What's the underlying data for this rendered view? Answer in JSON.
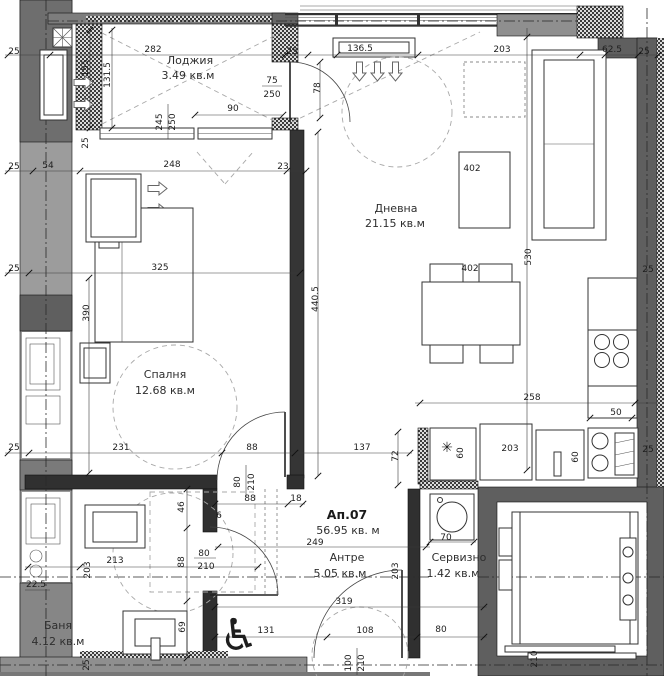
{
  "plan": {
    "apartment": {
      "number": "Ап.07",
      "area": "56.95 кв. м"
    },
    "rooms": {
      "loggia": {
        "name": "Лоджия",
        "area": "3.49 кв.м"
      },
      "living": {
        "name": "Дневна",
        "area": "21.15 кв.м"
      },
      "bedroom": {
        "name": "Спалня",
        "area": "12.68 кв.м"
      },
      "bath": {
        "name": "Баня",
        "area": "4.12 кв.м"
      },
      "hall": {
        "name": "Антре",
        "area": "5.05 кв.м"
      },
      "service": {
        "name": "Сервизно",
        "area": "1.42 кв.м"
      }
    },
    "dims": {
      "d6": "6",
      "d18": "18",
      "d22_5": "22.5",
      "d23": "23",
      "d25": "25",
      "d46": "46",
      "d50": "50",
      "d54": "54",
      "d60": "60",
      "d62_5": "62.5",
      "d69": "69",
      "d70": "70",
      "d72": "72",
      "d75": "75",
      "d78": "78",
      "d80": "80",
      "d88": "88",
      "d90": "90",
      "d100": "100",
      "d108": "108",
      "d131": "131",
      "d131_5": "131.5",
      "d136_5": "136.5",
      "d137": "137",
      "d155": "155",
      "d203": "203",
      "d210": "210",
      "d213": "213",
      "d231": "231",
      "d245": "245",
      "d248": "248",
      "d249": "249",
      "d250": "250",
      "d258": "258",
      "d282": "282",
      "d319": "319",
      "d325": "325",
      "d390": "390",
      "d402": "402",
      "d440_5": "440.5",
      "d530": "530"
    },
    "symbols": {
      "fridge_star": "✳",
      "wheelchair": "♿"
    }
  }
}
